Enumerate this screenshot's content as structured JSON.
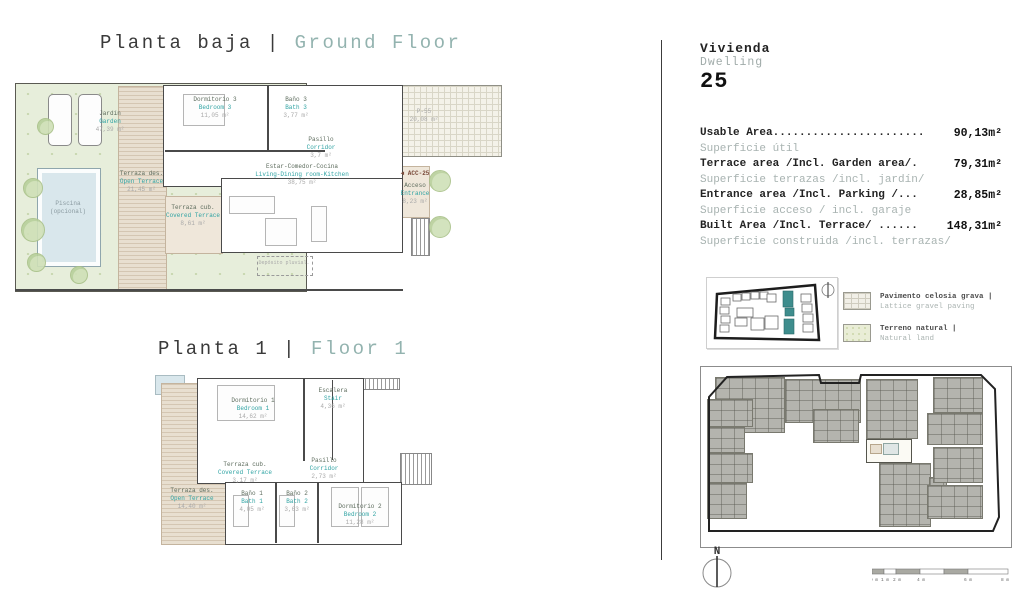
{
  "colors": {
    "accent_teal": "#2fa3a3",
    "title_teal": "#93b3af",
    "garden_green": "#e7eedb",
    "terrace_tan": "#e8dfd0",
    "pool_blue": "#d9e7ec",
    "building_gray": "#b4b4ae"
  },
  "titles": {
    "ground": {
      "es": "Planta baja",
      "sep": " | ",
      "en": "Ground Floor"
    },
    "floor1": {
      "es": "Planta 1",
      "sep": " | ",
      "en": "Floor 1"
    }
  },
  "ground_floor": {
    "rooms": {
      "jardin": {
        "es": "Jardín",
        "en": "Garden",
        "area": "47,39 m²"
      },
      "piscina": {
        "es": "Piscina",
        "en": "(opcional)",
        "area": ""
      },
      "open_terrace": {
        "es": "Terraza des.",
        "en": "Open Terrace",
        "area": "21,45 m²"
      },
      "covered_terrace": {
        "es": "Terraza cub.",
        "en": "Covered Terrace",
        "area": "8,61 m²"
      },
      "dorm3": {
        "es": "Dormitorio 3",
        "en": "Bedroom 3",
        "area": "11,05 m²"
      },
      "bath3": {
        "es": "Baño 3",
        "en": "Bath 3",
        "area": "3,77 m²"
      },
      "pasillo": {
        "es": "Pasillo",
        "en": "Corridor",
        "area": "3,7 m²"
      },
      "living": {
        "es": "Estar-Comedor-Cocina",
        "en": "Living-Dining room-Kitchen",
        "area": "38,75 m²"
      },
      "p55": {
        "es": "P-55",
        "en": "",
        "area": "20,08 m²"
      },
      "acceso": {
        "es": "Acceso",
        "en": "Entrance",
        "area": "8,23 m²"
      },
      "acc_tag": "◄ ACC-25",
      "deposito": "Depósito pluvial."
    }
  },
  "floor1_plan": {
    "rooms": {
      "dorm1": {
        "es": "Dormitorio 1",
        "en": "Bedroom 1",
        "area": "14,62 m²"
      },
      "escalera": {
        "es": "Escalera",
        "en": "Stair",
        "area": "4,36 m²"
      },
      "pasillo": {
        "es": "Pasillo",
        "en": "Corridor",
        "area": "2,73 m²"
      },
      "covered_terrace": {
        "es": "Terraza cub.",
        "en": "Covered Terrace",
        "area": "3,17 m²"
      },
      "open_terrace": {
        "es": "Terraza des.",
        "en": "Open Terrace",
        "area": "14,40 m²"
      },
      "bath1": {
        "es": "Baño 1",
        "en": "Bath 1",
        "area": "4,05 m²"
      },
      "bath2": {
        "es": "Baño 2",
        "en": "Bath 2",
        "area": "3,63 m²"
      },
      "dorm2": {
        "es": "Dormitorio 2",
        "en": "Bedroom 2",
        "area": "11,28 m²"
      }
    }
  },
  "panel": {
    "dwelling_label_es": "Vivienda",
    "dwelling_label_en": "Dwelling",
    "dwelling_number": "25",
    "areas": [
      {
        "en": "Usable Area.......................",
        "value": "90,13m²",
        "es": "Superficie útil"
      },
      {
        "en": "Terrace area /Incl. Garden area/.",
        "value": "79,31m²",
        "es": "Superficie terrazas /incl. jardín/"
      },
      {
        "en": "Entrance area /Incl. Parking /...",
        "value": "28,85m²",
        "es": "Superficie acceso / incl. garaje"
      },
      {
        "en": "Built Area /Incl. Terrace/ ......",
        "value": "148,31m²",
        "es": "Superficie construida /incl. terrazas/"
      }
    ],
    "legend": [
      {
        "es": "Pavimento celosia grava |",
        "en": "Lattice gravel paving"
      },
      {
        "es": "Terreno natural |",
        "en": "Natural land"
      }
    ],
    "north_label": "N",
    "scale_labels": [
      "0 m",
      "1 m",
      "2 m",
      "4 m",
      "6 m",
      "8 m"
    ]
  }
}
